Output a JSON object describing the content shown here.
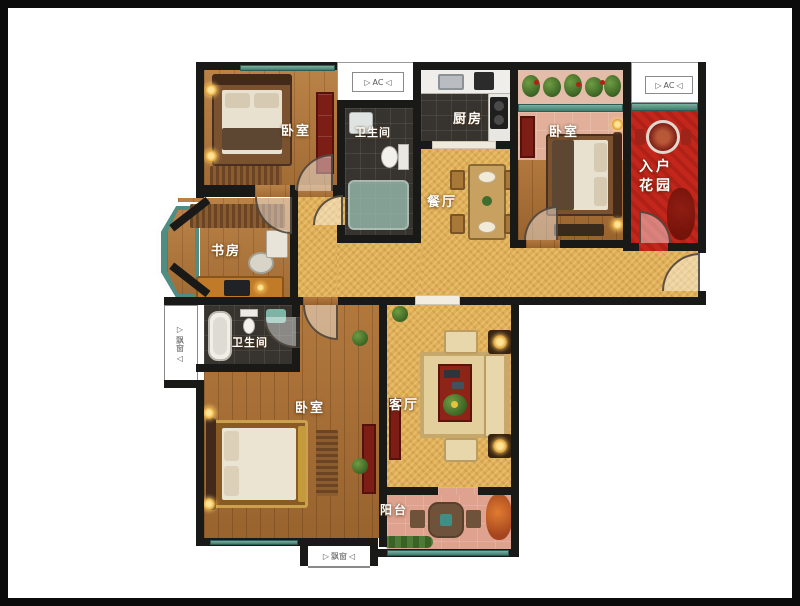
{
  "rooms": {
    "bedroom_top_left": {
      "label": "卧室"
    },
    "bathroom_top": {
      "label": "卫生间"
    },
    "kitchen": {
      "label": "厨房"
    },
    "bedroom_right": {
      "label": "卧室"
    },
    "entry_garden": {
      "line1": "入户",
      "line2": "花园"
    },
    "dining": {
      "label": "餐厅"
    },
    "study": {
      "label": "书房"
    },
    "bathroom_left": {
      "label": "卫生间"
    },
    "bedroom_bottom_left": {
      "label": "卧室"
    },
    "living_room": {
      "label": "客厅"
    },
    "balcony": {
      "label": "阳台"
    }
  },
  "markers": {
    "ac_top": "AC",
    "ac_right": "AC",
    "bay_window_left": "飘窗",
    "bay_window_bottom": "飘窗",
    "arrow_left": "▷",
    "arrow_right": "◁"
  },
  "colors": {
    "wall": "#191917",
    "wood_floor": "#b0773c",
    "dark_tile": "#37342f",
    "gold_floor": "#dfae58",
    "garden_red": "#c3271c",
    "balcony_pink": "#dfa28e",
    "window_teal": "#4f8d82",
    "furniture_red": "#7c1e16"
  }
}
